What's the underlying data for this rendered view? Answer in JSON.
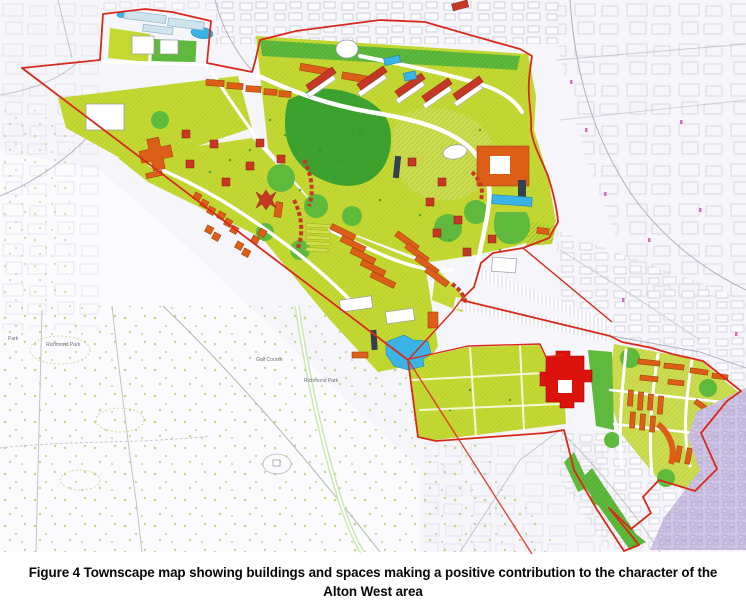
{
  "figure": {
    "caption_line1": "Figure 4 Townscape map showing buildings and spaces making a positive contribution to the character of the",
    "caption_line2": "Alton West area"
  },
  "map": {
    "area_name": "Alton West",
    "labels": [
      {
        "text": "Park"
      },
      {
        "text": "Richmond Park"
      },
      {
        "text": "Golf Course"
      },
      {
        "text": "Richmond Park"
      }
    ],
    "colors": {
      "map_bg": "#f5f5fa",
      "park_bg": "#fbfbfe",
      "basemap_line": "#b3b3c6",
      "park_dot": "#bccf7e",
      "boundary_red": "#d9291b",
      "open_space": "#c4d834",
      "open_space_light": "#ccdc52",
      "grass_green": "#5eb93c",
      "dark_green": "#3da32e",
      "building_orange": "#dd5f17",
      "slab_red": "#c63826",
      "landmark_red": "#dc120c",
      "dark_slab": "#35404e",
      "water_blue": "#3ab4e6",
      "pale_blue": "#cfe3ee",
      "purple_area": "#cec5e4",
      "purple_line": "#a396c8",
      "label_gray": "#6a6f77",
      "scan_mark_pink": "#c94fb0"
    }
  }
}
